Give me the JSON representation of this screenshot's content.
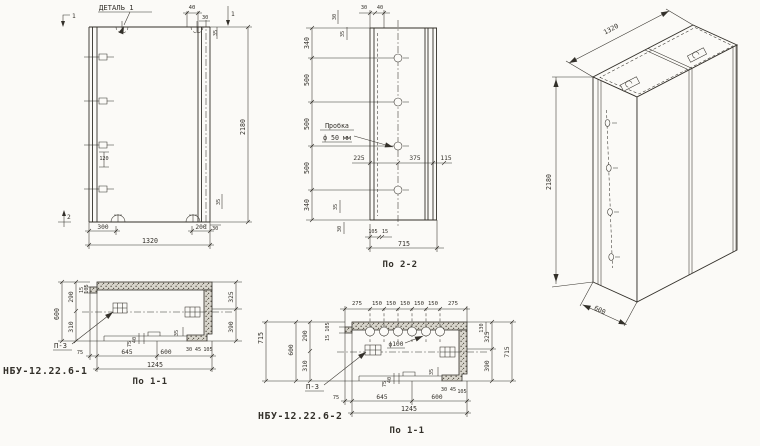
{
  "colors": {
    "ink": "#33302a",
    "paper": "#fbfaf7"
  },
  "front": {
    "detail_callout": "ДЕТАЛЬ 1",
    "mark_top_left": "1",
    "mark_top_right": "1",
    "mark_bottom": "2",
    "dim_top_40": "40",
    "dim_top_30": "30",
    "dim_top_35": "35",
    "dim_height": "2180",
    "dim_hooks": "120",
    "dim_bot_35": "35",
    "dim_bot_30": "30",
    "dim_300": "300",
    "dim_200": "200",
    "dim_width": "1320"
  },
  "section22": {
    "caption": "По 2-2",
    "plug_line1": "Пробка",
    "plug_line2": "ф 50 мм",
    "dim_top_30": "30",
    "dim_top_40": "40",
    "dim_small_30": "30",
    "dim_small_35": "35",
    "left_dims": [
      "340",
      "500",
      "500",
      "500",
      "340"
    ],
    "dim_225": "225",
    "dim_375": "375",
    "dim_115": "115",
    "dim_bsmall_35": "35",
    "dim_bsmall_30": "30",
    "dim_105": "105",
    "dim_15": "15",
    "dim_total": "715"
  },
  "iso": {
    "dim_width": "1320",
    "dim_height": "2180",
    "dim_depth": "600"
  },
  "section11a": {
    "title": "НБУ-12.22.6-1",
    "caption": "По 1-1",
    "plate_label": "П-3",
    "left_total": "600",
    "left_290": "290",
    "left_310": "310",
    "left_15": "15",
    "left_105": "105",
    "right_325": "325",
    "right_390": "390",
    "bottom_75": "75",
    "bottom_645": "645",
    "bottom_600": "600",
    "bottom_total": "1245",
    "small_35": "35",
    "small_30": "30",
    "small_45": "45",
    "small_105": "105",
    "small_75": "75",
    "small_40": "40"
  },
  "section11b": {
    "title": "НБУ-12.22.6-2",
    "caption": "По 1-1",
    "plate_label": "П-3",
    "hole_label": "ф100",
    "top_dims": [
      "275",
      "150",
      "150",
      "150",
      "150",
      "150",
      "275"
    ],
    "left_715": "715",
    "left_total": "600",
    "left_290": "290",
    "left_310": "310",
    "left_15": "15",
    "left_105": "105",
    "right_130": "130",
    "right_325": "325",
    "right_390": "390",
    "right_715": "715",
    "bottom_75": "75",
    "bottom_645": "645",
    "bottom_600": "600",
    "bottom_total": "1245",
    "small_35": "35",
    "small_30": "30",
    "small_45": "45",
    "small_105": "105",
    "small_75": "75",
    "small_40": "40"
  }
}
